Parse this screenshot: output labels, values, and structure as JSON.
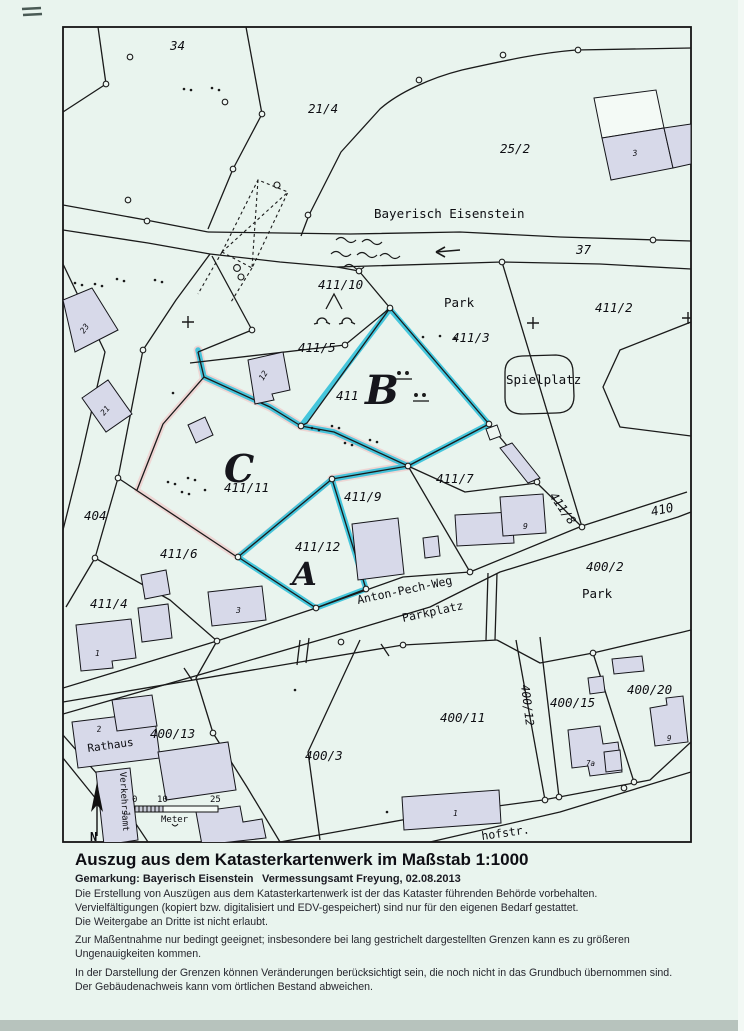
{
  "map": {
    "region_label": "Bayerisch Eisenstein",
    "street_top": "Hauptstraße (B 11)",
    "street_bottom": "hofstr.",
    "street_anton": "Anton-Pech-Weg",
    "parking": "Parkplatz",
    "park_upper": "Park",
    "park_lower": "Park",
    "playground": "Spielplatz",
    "town_hall": "Rathaus",
    "tourist_office": "Verkehrsamt",
    "marks": {
      "a": "A",
      "b": "B",
      "c": "C"
    },
    "road_numbers": {
      "r37": "37",
      "r410": "410"
    },
    "parcels": {
      "p34": "34",
      "p21_4": "21/4",
      "p25_2": "25/2",
      "p411_10": "411/10",
      "p411_2": "411/2",
      "p411_3": "411/3",
      "p411_5": "411/5",
      "p411": "411",
      "p411_11": "411/11",
      "p411_9": "411/9",
      "p411_7": "411/7",
      "p411_8": "411/8",
      "p411_6": "411/6",
      "p411_4": "411/4",
      "p411_12": "411/12",
      "p404": "404",
      "p400_2": "400/2",
      "p400_13": "400/13",
      "p400_3": "400/3",
      "p400_11": "400/11",
      "p400_12": "400/12",
      "p400_15": "400/15",
      "p400_20": "400/20"
    },
    "house_numbers": {
      "h3_top": "3",
      "h23": "23",
      "h21": "21",
      "h12": "12",
      "h9_mid": "9",
      "h3_anton": "3",
      "h1_411_4": "1",
      "h2_rathaus": "2",
      "h1_verkehr": "1",
      "h1_400_11": "1",
      "h7a": "7a",
      "h9_400_20": "9"
    },
    "scale_bar": {
      "t0": "0",
      "t10": "10",
      "t25": "25",
      "unit": "Meter",
      "north": "N"
    },
    "symbols": {
      "north_arrow": "north-arrow",
      "direction_arrow": "left-arrow",
      "stream": "stream-waves",
      "bridge": "dashed-bridge-outline",
      "trees": "tree-symbols",
      "survey_cross": "plus-survey-mark"
    },
    "colors": {
      "highlight": "#2fc0da",
      "pink": "#eed6d4",
      "building": "#d7d9e9",
      "paper": "#e9f4ee",
      "line": "#161616"
    }
  },
  "footer": {
    "title": "Auszug aus dem Katasterkartenwerk im Maßstab 1:1000",
    "gemarkung": "Gemarkung: Bayerisch Eisenstein",
    "office": "Vermessungsamt Freyung, 02.08.2013",
    "notes": [
      "Die Erstellung von Auszügen aus dem Katasterkartenwerk ist der das Kataster führenden Behörde vorbehalten.",
      "Vervielfältigungen (kopiert bzw. digitalisiert und EDV-gespeichert) sind nur für den eigenen Bedarf gestattet.",
      "Die Weitergabe an Dritte ist nicht erlaubt.",
      "Zur Maßentnahme nur bedingt geeignet; insbesondere bei lang gestrichelt dargestellten Grenzen kann es zu größeren Ungenauigkeiten kommen.",
      "In der Darstellung der Grenzen können Veränderungen berücksichtigt sein, die noch nicht in das Grundbuch übernommen sind.",
      "Der Gebäudenachweis kann vom örtlichen Bestand abweichen."
    ]
  }
}
